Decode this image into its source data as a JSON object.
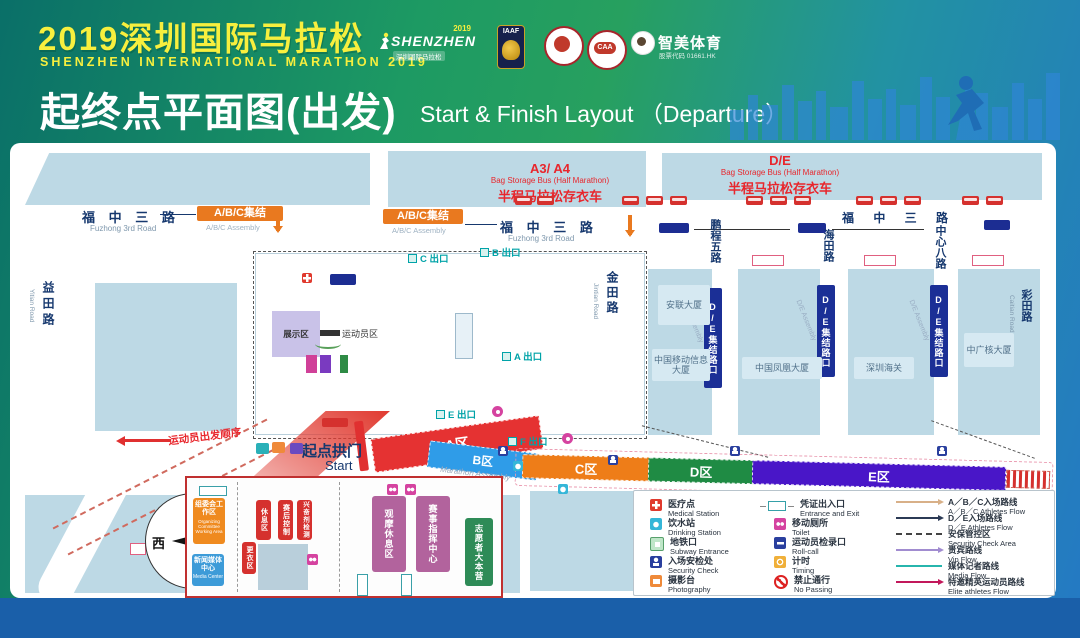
{
  "header": {
    "title_cn": "2019深圳国际马拉松",
    "title_en": "SHENZHEN INTERNATIONAL MARATHON 2019",
    "subtitle_cn": "起终点平面图(出发)",
    "subtitle_en": "Start & Finish Layout （Departure）",
    "logo_marathon": {
      "year": "2019",
      "name": "SHENZHEN",
      "sub": "深圳国际马拉松"
    },
    "logo_iaaf": "IAAF",
    "logo_caa": "CAA",
    "logo_zhimei": {
      "name": "智美体育",
      "sub": "股票代码 01661.HK"
    }
  },
  "map": {
    "roads": {
      "fuzhong_cn": "福 中 三 路",
      "fuzhong_en": "Fuzhong 3rd Road",
      "yitian_cn": "益田路",
      "yitian_en": "Yitian Road",
      "jintian_cn": "金田路",
      "jintian_en": "Jintian Road",
      "pengcheng5_cn": "鹏程五路",
      "haitian_cn": "海田路",
      "zhongxin8_cn": "中心八路",
      "caitian_cn": "彩田路",
      "caitian_en": "Caitian Road"
    },
    "badges": {
      "abc_assembly_cn": "A/B/C集结",
      "abc_assembly_en": "A/B/C  Assembly",
      "de_assembly_cn": "D/E集结路口",
      "de_assembly_en": "D/E  Assembly"
    },
    "bag_storage_abc": {
      "title": "A3/ A4",
      "en": "Bag Storage Bus (Half Marathon)",
      "cn": "半程马拉松存衣车"
    },
    "bag_storage_de": {
      "title": "D/E",
      "en": "Bag Storage Bus (Half Marathon)",
      "cn": "半程马拉松存衣车"
    },
    "buildings": {
      "anlian": "安联大厦",
      "mobile": "中国移动信息大厦",
      "phoenix": "中国凤凰大厦",
      "customs": "深圳海关",
      "cgn": "中广核大厦"
    },
    "center": {
      "exhibition": "展示区",
      "athletes": "运动员区"
    },
    "start": {
      "arch_cn": "起点拱门",
      "arch_en": "Start",
      "order": "运动员出发顺序"
    },
    "zones": {
      "a": {
        "label": "A区",
        "color": "#e53232"
      },
      "b": {
        "label": "B区",
        "color": "#2f9ce8",
        "sub": "Marathon Assembly"
      },
      "c": {
        "label": "C区",
        "color": "#ee7d18"
      },
      "d": {
        "label": "D区",
        "color": "#1f8b44"
      },
      "e": {
        "label": "E区",
        "color": "#4916c8",
        "sub": "Half Marathon Assembly"
      }
    },
    "exits": {
      "a": "A 出口",
      "b": "B 出口",
      "c": "C 出口",
      "e": "E 出口",
      "f": "F 出口"
    },
    "compass": {
      "north": "北",
      "south": "南",
      "west": "西",
      "east": "东"
    }
  },
  "inset": {
    "committee_cn": "组委会工作区",
    "committee_en": "Organizing Committee Working Area",
    "media_cn": "新闻媒体中心",
    "media_en": "Media Center",
    "rest": "休息区",
    "post_race_control": "赛后控制",
    "doping_control": "兴奋剂检测",
    "changing": "更衣区",
    "viewing_rest": "观摩休息区",
    "command_center": "赛事指挥中心",
    "volunteer_camp": "志愿者大本营"
  },
  "legend": {
    "items": [
      {
        "cn": "医疗点",
        "en": "Medical Station"
      },
      {
        "cn": "饮水站",
        "en": "Drinking Station"
      },
      {
        "cn": "地铁口",
        "en": "Subway Entrance"
      },
      {
        "cn": "入场安检处",
        "en": "Security Check"
      },
      {
        "cn": "摄影台",
        "en": "Photography"
      },
      {
        "cn": "凭证出入口",
        "en": "Entrance and Exit"
      },
      {
        "cn": "移动厕所",
        "en": "Toilet"
      },
      {
        "cn": "运动员检录口",
        "en": "Roll-call"
      },
      {
        "cn": "计时",
        "en": "Timing"
      },
      {
        "cn": "禁止通行",
        "en": "No Passing"
      }
    ],
    "flows": [
      {
        "cn": "A／B／C入场路线",
        "en": "A／B／C Athletes Flow",
        "color": "#d8b088"
      },
      {
        "cn": "D／E入场路线",
        "en": "D／E Athletes Flow",
        "color": "#2b3a55"
      },
      {
        "cn": "安保管控区",
        "en": "Security Check Area",
        "color": "#444444"
      },
      {
        "cn": "贵宾路线",
        "en": "Vip Flow",
        "color": "#a18cd0"
      },
      {
        "cn": "媒体记者路线",
        "en": "Media Flow",
        "color": "#27b5ad"
      },
      {
        "cn": "特邀精英运动员路线",
        "en": "Elite athletes Flow",
        "color": "#c2185b"
      }
    ]
  }
}
